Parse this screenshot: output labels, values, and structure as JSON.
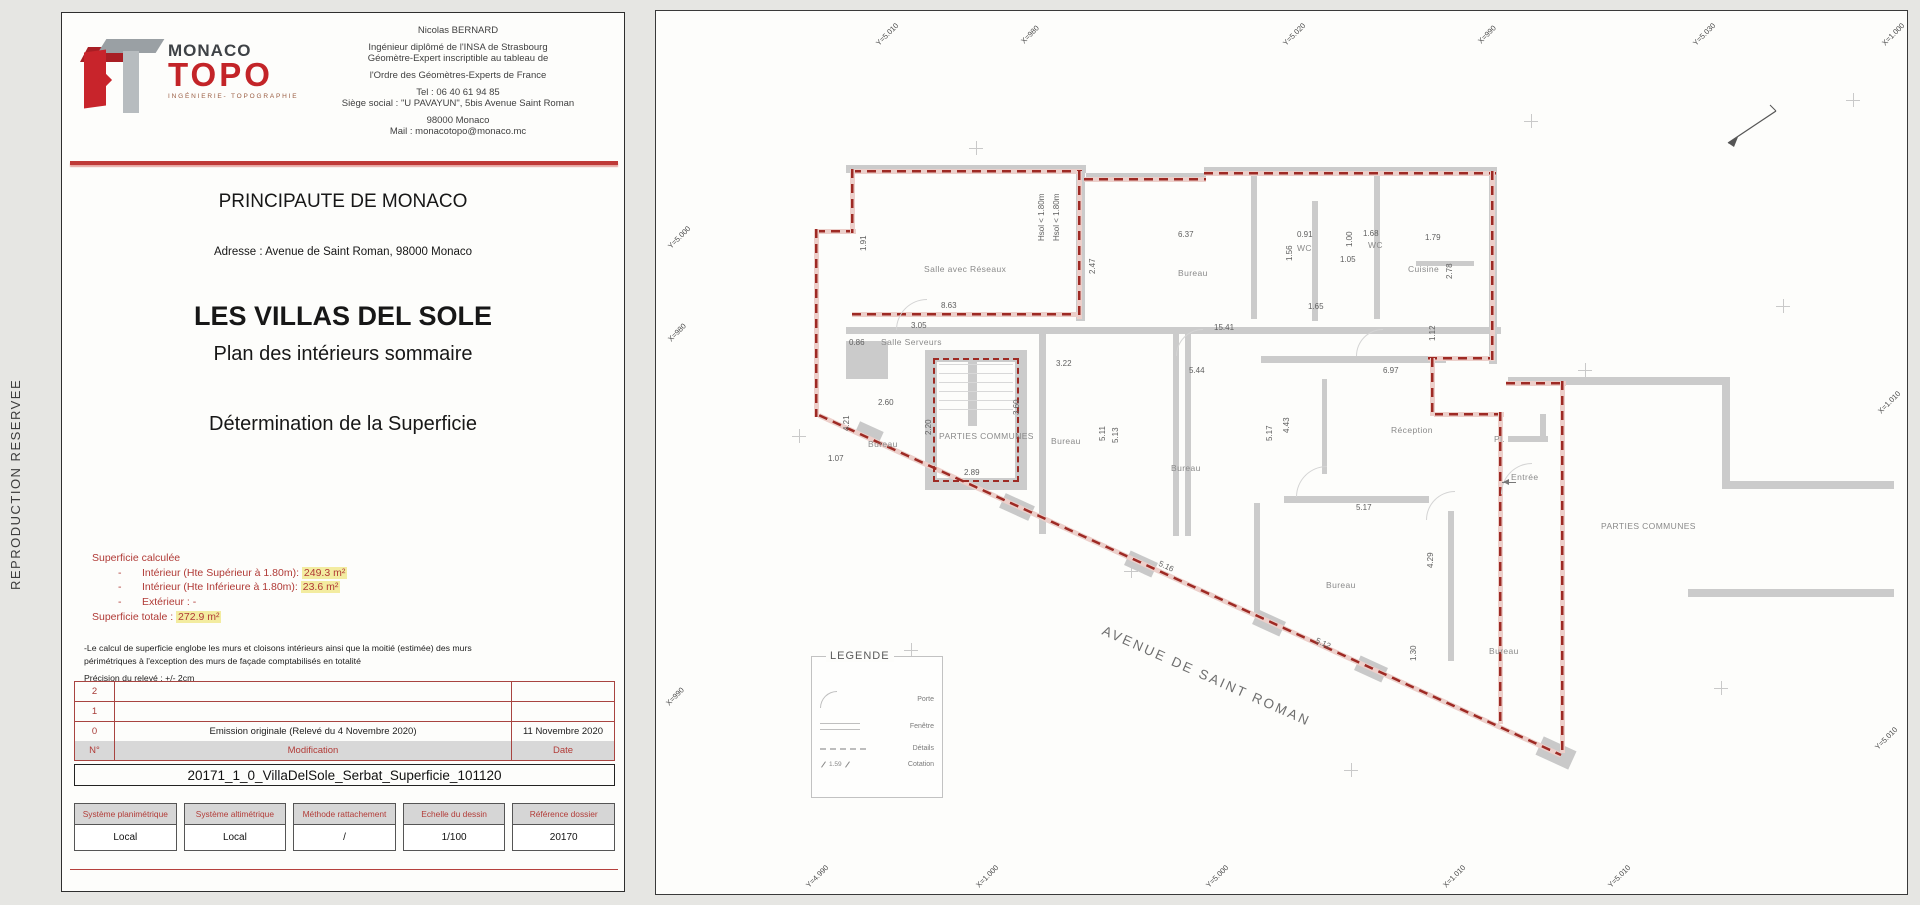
{
  "page": {
    "side_label": "REPRODUCTION RESERVEE"
  },
  "colors": {
    "brand_red": "#c32428",
    "accent_red": "#bf3a38",
    "table_red": "#a84440",
    "boundary_red": "#9e2a24",
    "wall_gray": "#cbcbcb",
    "header_gray": "#d8d8d8",
    "highlight_yellow": "#f3eca0"
  },
  "title_block": {
    "logo": {
      "brand_line1": "MONACO",
      "brand_line2": "TOPO",
      "subtitle": "INGÉNIERIE- TOPOGRAPHIE"
    },
    "contact": {
      "lines": [
        "Nicolas BERNARD",
        "Ingénieur diplômé de l'INSA de Strasbourg",
        "Géomètre-Expert inscriptible au tableau de",
        "l'Ordre des Géomètres-Experts de France",
        "Tel : 06 40 61 94 85",
        "Siège social : \"U PAVAYUN\", 5bis Avenue Saint Roman",
        "98000 Monaco",
        "Mail : monacotopo@monaco.mc"
      ]
    },
    "country": "PRINCIPAUTE DE MONACO",
    "address": "Adresse : Avenue de Saint Roman, 98000 Monaco",
    "project": "LES VILLAS DEL SOLE",
    "subtitle1": "Plan des intérieurs sommaire",
    "subtitle2": "Détermination de la Superficie",
    "superficie": {
      "heading": "Superficie calculée",
      "items": [
        {
          "dash": "-",
          "pre": "Intérieur (Hte Supérieur à 1.80m): ",
          "hl": "249.3 m²"
        },
        {
          "dash": "-",
          "pre": "Intérieur (Hte Inférieure à 1.80m): ",
          "hl": "23.6 m²"
        },
        {
          "dash": "-",
          "pre": "Extérieur : -",
          "hl": ""
        }
      ],
      "total_pre": "Superficie totale : ",
      "total_hl": "272.9 m²"
    },
    "notes": {
      "note1": "-Le calcul de superficie englobe les murs et cloisons intérieurs ainsi que la moitié (estimée) des murs périmétriques à l'exception des murs de façade comptabilisés en totalité",
      "note2": "Précision du relevé : +/- 2cm"
    },
    "revisions": {
      "headers": {
        "num": "N°",
        "mod": "Modification",
        "date": "Date"
      },
      "rows": [
        {
          "num": "2",
          "mod": "",
          "date": ""
        },
        {
          "num": "1",
          "mod": "",
          "date": ""
        },
        {
          "num": "0",
          "mod": "Emission originale (Relevé du 4 Novembre 2020)",
          "date": "11 Novembre 2020"
        }
      ]
    },
    "filename": "20171_1_0_VillaDelSole_Serbat_Superficie_101120",
    "specs": [
      {
        "label": "Système planimétrique",
        "value": "Local"
      },
      {
        "label": "Système altimétrique",
        "value": "Local"
      },
      {
        "label": "Méthode rattachement",
        "value": "/"
      },
      {
        "label": "Echelle du dessin",
        "value": "1/100"
      },
      {
        "label": "Référence dossier",
        "value": "20170"
      }
    ]
  },
  "plan": {
    "street": "AVENUE DE SAINT ROMAN",
    "legend": {
      "title": "LEGENDE",
      "items": [
        "Porte",
        "Fenêtre",
        "Détails",
        "Cotation"
      ],
      "cotation_sample": "1.59"
    },
    "rooms": [
      {
        "t": "Salle avec Réseaux",
        "x": 268,
        "y": 253
      },
      {
        "t": "Bureau",
        "x": 522,
        "y": 257
      },
      {
        "t": "WC",
        "x": 641,
        "y": 232
      },
      {
        "t": "WC",
        "x": 712,
        "y": 229
      },
      {
        "t": "Cuisine",
        "x": 752,
        "y": 253
      },
      {
        "t": "Salle Serveurs",
        "x": 225,
        "y": 326
      },
      {
        "t": "PARTIES COMMUNES",
        "x": 283,
        "y": 420
      },
      {
        "t": "Bureau",
        "x": 212,
        "y": 428
      },
      {
        "t": "Bureau",
        "x": 395,
        "y": 425
      },
      {
        "t": "Bureau",
        "x": 515,
        "y": 452
      },
      {
        "t": "Réception",
        "x": 735,
        "y": 414
      },
      {
        "t": "Pl.",
        "x": 838,
        "y": 423
      },
      {
        "t": "Entrée",
        "x": 855,
        "y": 461
      },
      {
        "t": "PARTIES COMMUNES",
        "x": 945,
        "y": 510
      },
      {
        "t": "Bureau",
        "x": 670,
        "y": 569
      },
      {
        "t": "Bureau",
        "x": 833,
        "y": 635
      }
    ],
    "dims": [
      {
        "t": "1.91",
        "x": 203,
        "y": 240,
        "rot": -90
      },
      {
        "t": "8.63",
        "x": 285,
        "y": 290
      },
      {
        "t": "3.05",
        "x": 255,
        "y": 310
      },
      {
        "t": "15.41",
        "x": 558,
        "y": 312
      },
      {
        "t": "0.86",
        "x": 193,
        "y": 327
      },
      {
        "t": "6.37",
        "x": 522,
        "y": 219
      },
      {
        "t": "2.47",
        "x": 432,
        "y": 263,
        "rot": -90
      },
      {
        "t": "Hsol < 1.80m",
        "x": 381,
        "y": 230,
        "rot": -90
      },
      {
        "t": "Hsol < 1.80m",
        "x": 396,
        "y": 230,
        "rot": -90
      },
      {
        "t": "0.91",
        "x": 641,
        "y": 219
      },
      {
        "t": "1.56",
        "x": 629,
        "y": 250,
        "rot": -90
      },
      {
        "t": "1.68",
        "x": 707,
        "y": 218
      },
      {
        "t": "1.00",
        "x": 689,
        "y": 236,
        "rot": -90
      },
      {
        "t": "1.79",
        "x": 769,
        "y": 222
      },
      {
        "t": "2.78",
        "x": 789,
        "y": 268,
        "rot": -90
      },
      {
        "t": "1.65",
        "x": 652,
        "y": 291
      },
      {
        "t": "1.05",
        "x": 684,
        "y": 244
      },
      {
        "t": "3.22",
        "x": 400,
        "y": 348
      },
      {
        "t": "5.44",
        "x": 533,
        "y": 355
      },
      {
        "t": "2.60",
        "x": 222,
        "y": 387
      },
      {
        "t": "2.20",
        "x": 268,
        "y": 424,
        "rot": -90
      },
      {
        "t": "3.60",
        "x": 356,
        "y": 404,
        "rot": -90
      },
      {
        "t": "2.89",
        "x": 308,
        "y": 457
      },
      {
        "t": "5.11",
        "x": 442,
        "y": 430,
        "rot": -90
      },
      {
        "t": "5.13",
        "x": 455,
        "y": 432,
        "rot": -90
      },
      {
        "t": "6.97",
        "x": 727,
        "y": 355
      },
      {
        "t": "4.43",
        "x": 626,
        "y": 422,
        "rot": -90
      },
      {
        "t": "5.17",
        "x": 609,
        "y": 430,
        "rot": -90
      },
      {
        "t": "5.17",
        "x": 700,
        "y": 492
      },
      {
        "t": "1.12",
        "x": 772,
        "y": 330,
        "rot": -90
      },
      {
        "t": "1.07",
        "x": 172,
        "y": 443
      },
      {
        "t": "4.21",
        "x": 186,
        "y": 420,
        "rot": -90
      },
      {
        "t": "5.16",
        "x": 505,
        "y": 548,
        "rot": 25
      },
      {
        "t": "5.12",
        "x": 662,
        "y": 625,
        "rot": 25
      },
      {
        "t": "4.29",
        "x": 770,
        "y": 557,
        "rot": -90
      },
      {
        "t": "1.30",
        "x": 753,
        "y": 650,
        "rot": -90
      }
    ],
    "grid_labels": [
      {
        "t": "Y=5.010",
        "x": 218,
        "y": 30
      },
      {
        "t": "X=980",
        "x": 363,
        "y": 28
      },
      {
        "t": "Y=5.020",
        "x": 625,
        "y": 30
      },
      {
        "t": "X=990",
        "x": 820,
        "y": 28
      },
      {
        "t": "Y=5.030",
        "x": 1035,
        "y": 30
      },
      {
        "t": "X=1.000",
        "x": 1224,
        "y": 30
      },
      {
        "t": "Y=5.000",
        "x": 10,
        "y": 233
      },
      {
        "t": "X=980",
        "x": 10,
        "y": 326
      },
      {
        "t": "X=990",
        "x": 8,
        "y": 690
      },
      {
        "t": "X=1.010",
        "x": 1220,
        "y": 398
      },
      {
        "t": "Y=5.010",
        "x": 1217,
        "y": 734
      },
      {
        "t": "Y=4.990",
        "x": 148,
        "y": 872
      },
      {
        "t": "X=1.000",
        "x": 318,
        "y": 872
      },
      {
        "t": "Y=5.000",
        "x": 548,
        "y": 872
      },
      {
        "t": "X=1.010",
        "x": 785,
        "y": 872
      },
      {
        "t": "Y=5.010",
        "x": 950,
        "y": 872
      }
    ]
  }
}
